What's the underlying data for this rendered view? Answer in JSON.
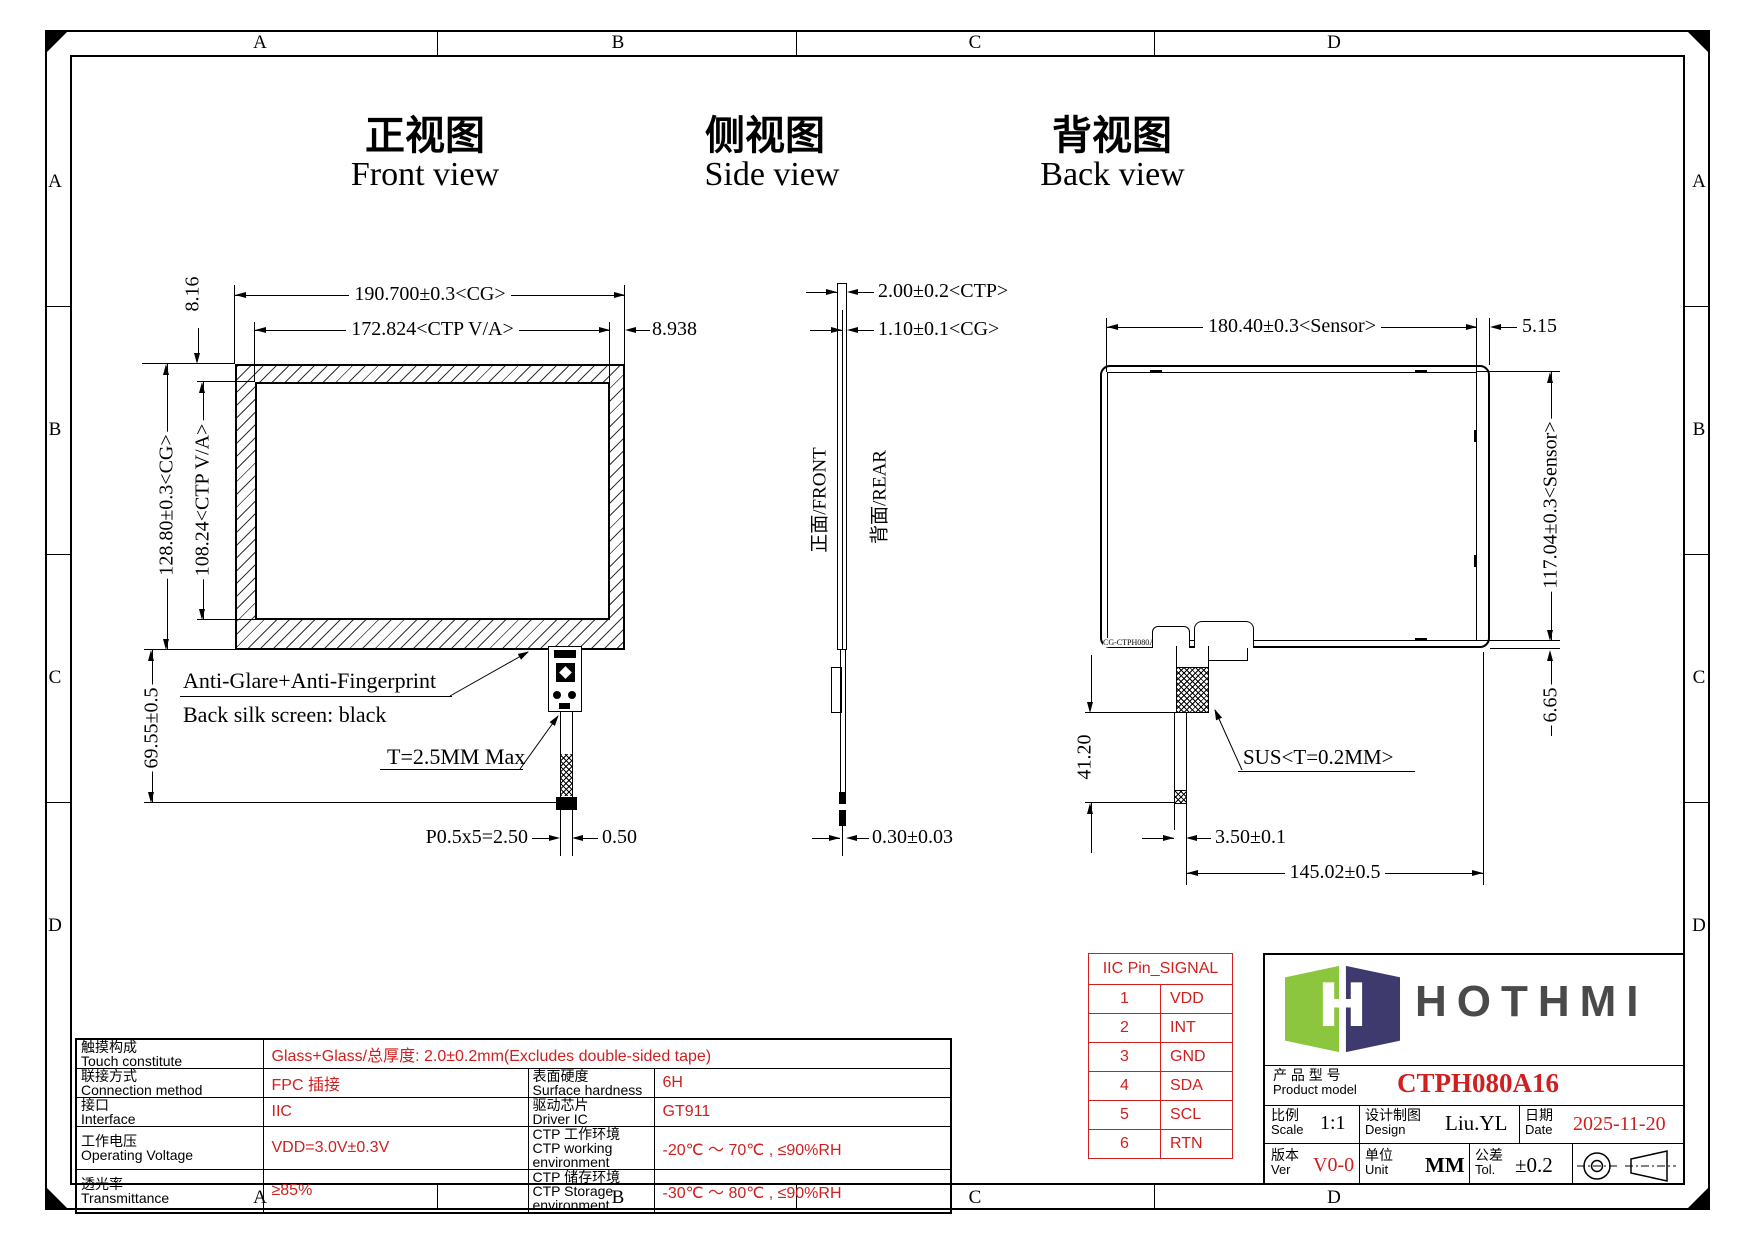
{
  "sheet": {
    "zones": [
      "A",
      "B",
      "C",
      "D"
    ]
  },
  "views": {
    "front": {
      "title_cn": "正视图",
      "title_en": "Front view"
    },
    "side": {
      "title_cn": "侧视图",
      "title_en": "Side view"
    },
    "back": {
      "title_cn": "背视图",
      "title_en": "Back view"
    }
  },
  "front": {
    "cg_width": "190.700±0.3<CG>",
    "va_width": "172.824<CTP V/A>",
    "right_gap": "8.938",
    "top_gap": "8.16",
    "cg_height": "128.80±0.3<CG>",
    "va_height": "108.24<CTP V/A>",
    "tail_length": "69.55±0.5",
    "note_glare": "Anti-Glare+Anti-Fingerprint",
    "note_silk": "Back silk screen: black",
    "note_thickness": "T=2.5MM Max",
    "pitch": "P0.5x5=2.50",
    "offset": "0.50"
  },
  "side": {
    "ctp_thickness": "2.00±0.2<CTP>",
    "cg_thickness": "1.10±0.1<CG>",
    "front_face": "正面/FRONT",
    "rear_face": "背面/REAR",
    "fpc_thickness": "0.30±0.03"
  },
  "back": {
    "sensor_width": "180.40±0.3<Sensor>",
    "right_gap": "5.15",
    "sensor_height": "117.04±0.3<Sensor>",
    "bottom_gap": "6.65",
    "fpc_length": "41.20",
    "sus_note": "SUS<T=0.2MM>",
    "tail_width": "3.50±0.1",
    "fpc_position": "145.02±0.5",
    "part_code": "CG-CTPH080A16_V0"
  },
  "iic_table": {
    "header": "IIC Pin_SIGNAL",
    "pins": [
      {
        "no": "1",
        "signal": "VDD"
      },
      {
        "no": "2",
        "signal": "INT"
      },
      {
        "no": "3",
        "signal": "GND"
      },
      {
        "no": "4",
        "signal": "SDA"
      },
      {
        "no": "5",
        "signal": "SCL"
      },
      {
        "no": "6",
        "signal": "RTN"
      }
    ]
  },
  "spec_table": {
    "row1": {
      "label_cn": "触摸构成",
      "label_en": "Touch constitute",
      "value": "Glass+Glass/总厚度: 2.0±0.2mm(Excludes double-sided tape)"
    },
    "left": [
      {
        "label_cn": "联接方式",
        "label_en": "Connection method",
        "value": "FPC 插接"
      },
      {
        "label_cn": "接口",
        "label_en": "Interface",
        "value": "IIC"
      },
      {
        "label_cn": "工作电压",
        "label_en": "Operating Voltage",
        "value": "VDD=3.0V±0.3V"
      },
      {
        "label_cn": "透光率",
        "label_en": "Transmittance",
        "value": "≥85%"
      }
    ],
    "right": [
      {
        "label_cn": "表面硬度",
        "label_en": "Surface hardness",
        "value": "6H"
      },
      {
        "label_cn": "驱动芯片",
        "label_en": "Driver IC",
        "value": "GT911"
      },
      {
        "label_cn": "CTP 工作环境",
        "label_en": "CTP working environment",
        "value": "-20℃ ～ 70℃ , ≤90%RH"
      },
      {
        "label_cn": "CTP 储存环境",
        "label_en": "CTP Storage environment",
        "value": "-30℃ ～ 80℃ , ≤90%RH"
      }
    ]
  },
  "title_block": {
    "product_label_cn": "产 品 型 号",
    "product_label_en": "Product model",
    "product_model": "CTPH080A16",
    "scale_cn": "比例",
    "scale_en": "Scale",
    "scale_value": "1:1",
    "design_cn": "设计制图",
    "design_en": "Design",
    "design_value": "Liu.YL",
    "date_cn": "日期",
    "date_en": "Date",
    "date_value": "2025-11-20",
    "ver_cn": "版本",
    "ver_en": "Ver",
    "ver_value": "V0-0",
    "unit_cn": "单位",
    "unit_en": "Unit",
    "unit_value": "MM",
    "tol_cn": "公差",
    "tol_en": "Tol.",
    "tol_value": "±0.2"
  },
  "logo": {
    "text": "HOTHMI"
  },
  "colors": {
    "accent_red": "#d01f1f",
    "logo_green": "#8cc63e",
    "logo_navy": "#3e3a6d",
    "logo_gray": "#4a4a4a"
  }
}
